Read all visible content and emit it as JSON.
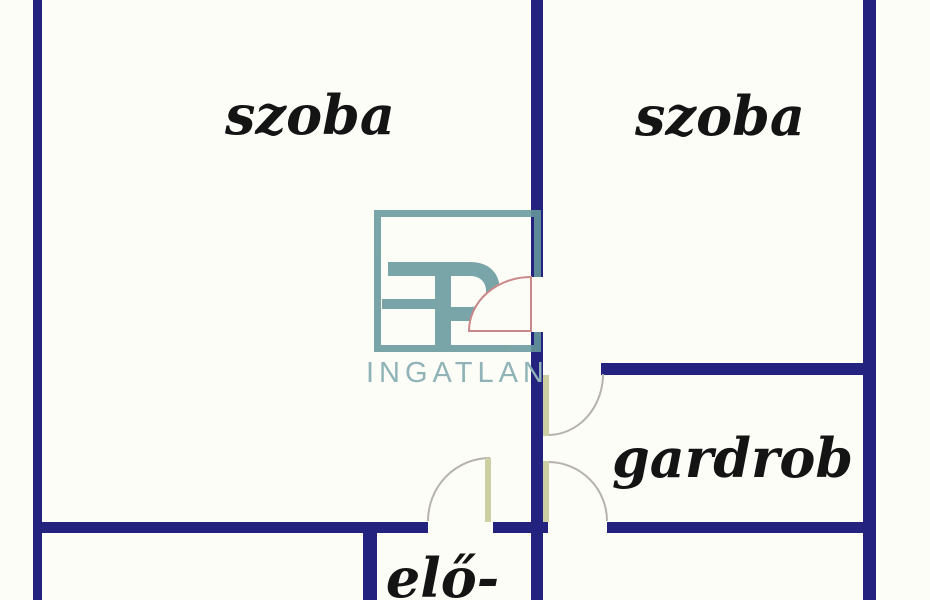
{
  "image": {
    "type": "floor-plan",
    "width": 930,
    "height": 600
  },
  "labels": {
    "room_left": "szoba",
    "room_right": "szoba",
    "closet": "gardrob",
    "hallway": "elő-"
  },
  "watermark": {
    "brand": "INGATLAN"
  },
  "colors": {
    "wall": "#23237f",
    "door_arc_pink": "#c9898a",
    "door_arc_gray": "#b6b2ae",
    "door_leaf": "#cfcfa4",
    "door_fan_fill": "#fdfdf8",
    "watermark_shape": "#689a9d",
    "watermark_text": "#8fb3b6",
    "label_text": "#141414",
    "background": "#fdfdf8"
  }
}
